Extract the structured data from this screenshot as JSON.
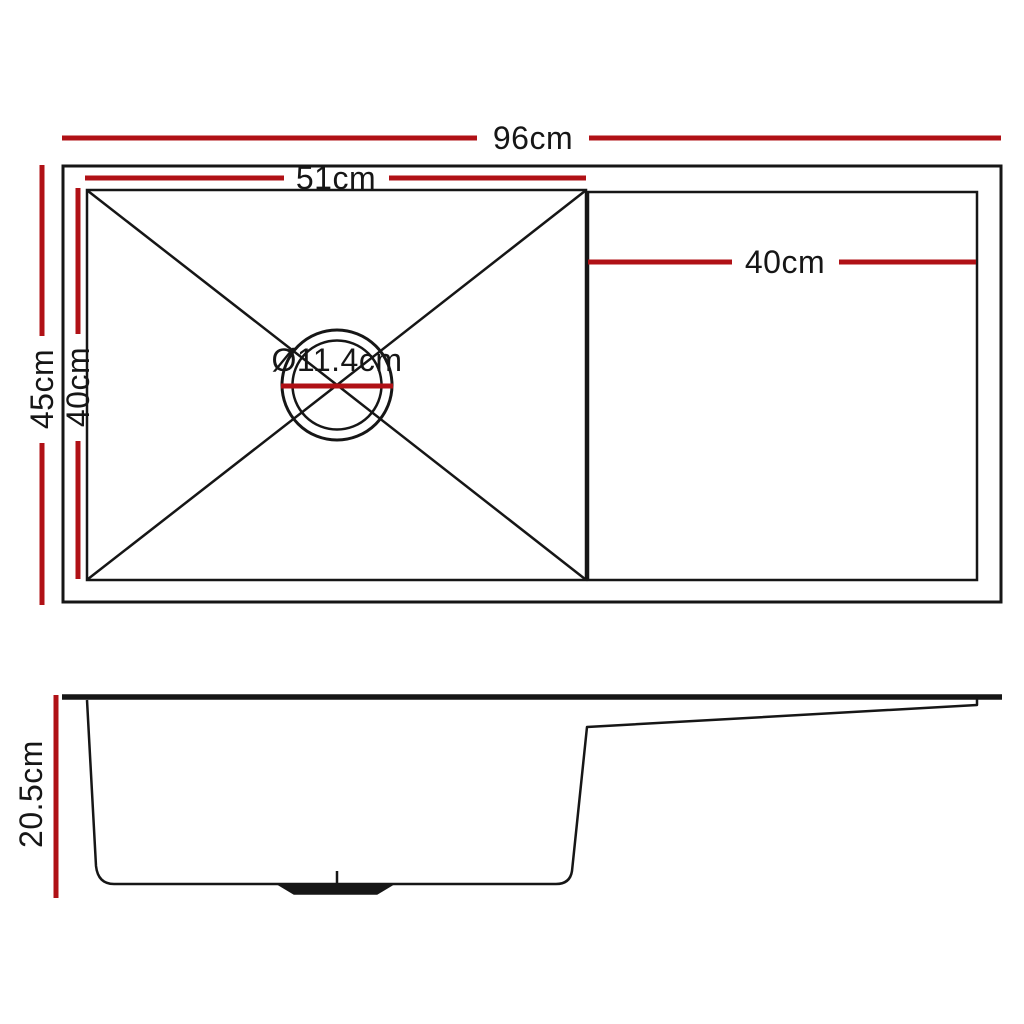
{
  "colors": {
    "dimension_red": "#b01116",
    "line_black": "#161616",
    "background": "#ffffff"
  },
  "top_view": {
    "overall_width": "96cm",
    "overall_depth": "45cm",
    "bowl_width": "51cm",
    "bowl_depth": "40cm",
    "drainer_width": "40cm",
    "drain_diameter": "Ø11.4cm"
  },
  "side_view": {
    "overall_height": "20.5cm"
  }
}
